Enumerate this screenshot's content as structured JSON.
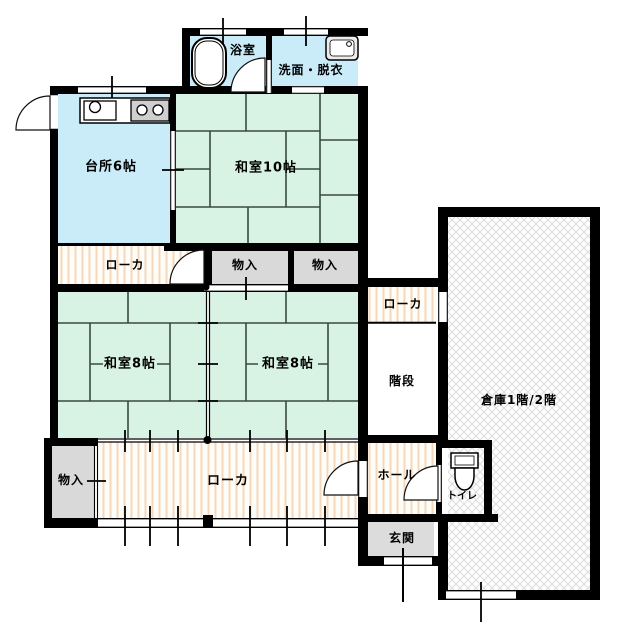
{
  "floorplan": {
    "rooms": {
      "bath": {
        "label": "浴室"
      },
      "washroom": {
        "label": "洗面・脱衣"
      },
      "kitchen": {
        "label": "台所6帖"
      },
      "japanese_room_10": {
        "label": "和室10帖"
      },
      "japanese_room_8_left": {
        "label": "和室8帖"
      },
      "japanese_room_8_right": {
        "label": "和室8帖"
      },
      "corridor_upper": {
        "label": "ローカ"
      },
      "corridor_lower": {
        "label": "ローカ"
      },
      "corridor_right": {
        "label": "ローカ"
      },
      "closet_upper_left": {
        "label": "物入"
      },
      "closet_upper_right": {
        "label": "物入"
      },
      "closet_lower": {
        "label": "物入"
      },
      "stairs": {
        "label": "階段"
      },
      "hall": {
        "label": "ホール"
      },
      "toilet": {
        "label": "トイレ"
      },
      "entrance": {
        "label": "玄関"
      },
      "warehouse": {
        "label": "倉庫1階/2階"
      }
    },
    "colors": {
      "room_blue": "#c9ecf8",
      "tatami_green": "#d8f3e3",
      "closet_gray": "#d9d9d9",
      "toilet_yellow": "#f8f6cd",
      "corridor_stripe": "#f5d8bb",
      "wall_black": "#000000",
      "hatch_gray": "#d9d9d9",
      "tatami_line": "#3a4a42"
    },
    "icons": {
      "bath": "bathtub-icon",
      "washroom": "washbasin-icon",
      "kitchen": [
        "kitchen-sink-icon",
        "stove-icon"
      ],
      "toilet": "toilet-icon"
    }
  }
}
